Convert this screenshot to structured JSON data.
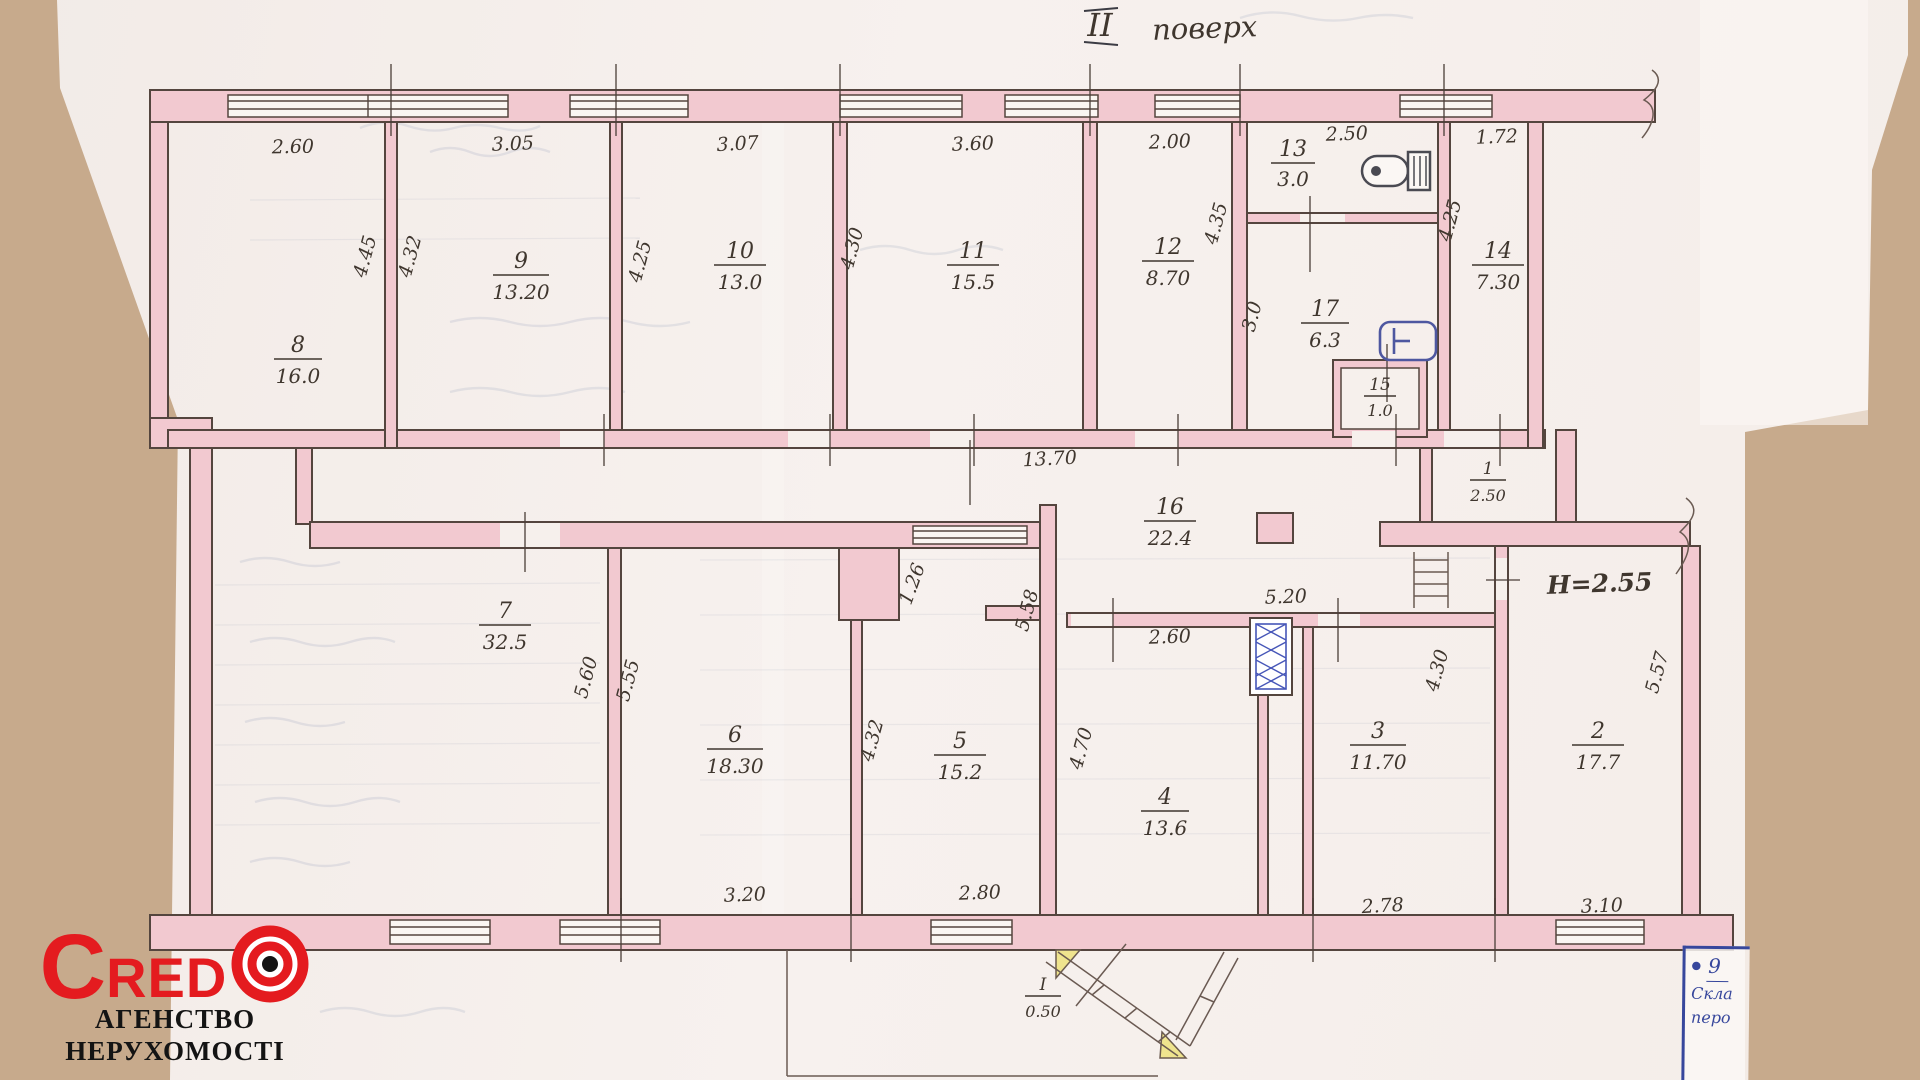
{
  "title": {
    "numeral": "II",
    "word": "поверх"
  },
  "note_height": "Н=2.55",
  "rooms": [
    {
      "n": "8",
      "a": "16.0"
    },
    {
      "n": "9",
      "a": "13.20"
    },
    {
      "n": "10",
      "a": "13.0"
    },
    {
      "n": "11",
      "a": "15.5"
    },
    {
      "n": "12",
      "a": "8.70"
    },
    {
      "n": "13",
      "a": "3.0"
    },
    {
      "n": "17",
      "a": "6.3"
    },
    {
      "n": "14",
      "a": "7.30"
    },
    {
      "n": "15",
      "a": "1.0"
    },
    {
      "n": "1",
      "a": "2.50"
    },
    {
      "n": "16",
      "a": "22.4"
    },
    {
      "n": "7",
      "a": "32.5"
    },
    {
      "n": "6",
      "a": "18.30"
    },
    {
      "n": "5",
      "a": "15.2"
    },
    {
      "n": "4",
      "a": "13.6"
    },
    {
      "n": "3",
      "a": "11.70"
    },
    {
      "n": "2",
      "a": "17.7"
    },
    {
      "n": "I",
      "a": "0.50"
    }
  ],
  "dims": {
    "top_r8": "2.60",
    "top_r9": "3.05",
    "top_r10": "3.07",
    "top_r11": "3.60",
    "top_r12": "2.00",
    "top_r13": "2.50",
    "top_r14": "1.72",
    "h_r8": "4.45",
    "h_r9": "4.32",
    "h_r9_r10": "4.25",
    "h_r10_r11": "4.30",
    "h_r12": "4.35",
    "h_r17": "3.0",
    "h_r14": "4.25",
    "corridor": "13.70",
    "hall_right": "5.20",
    "r4_top": "2.60",
    "door_r5": "1.26",
    "h_r5_right": "5.58",
    "h_r4_left": "4.70",
    "h_r7_right": "5.60",
    "h_r6_left": "5.55",
    "h_r5_left": "4.32",
    "h_r3_right": "4.30",
    "h_stair_right": "5.57",
    "bottom_r6": "3.20",
    "bottom_r5": "2.80",
    "bottom_r3": "2.78",
    "bottom_r2": "3.10"
  },
  "logo": {
    "brand_c": "C",
    "brand_red": "RED",
    "tagline1": "АГЕНСТВО",
    "tagline2": "НЕРУХОМОСТІ"
  },
  "stamp": {
    "number": "9",
    "line1": "Скла",
    "line2": "перо"
  },
  "colors": {
    "wall_pink": "#f2c9d0",
    "ink": "#3f362e",
    "blue_ink": "#3b4da8",
    "logo_red": "#e41b1f",
    "paper": "#f5efec",
    "backdrop": "#c7aa8c"
  }
}
